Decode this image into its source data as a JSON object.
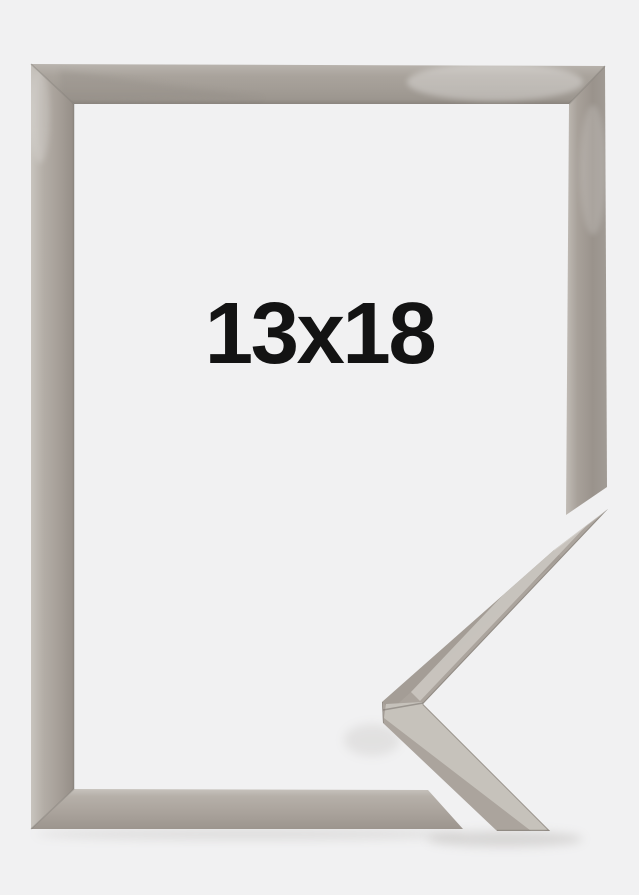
{
  "product_image": {
    "size_label": "13x18",
    "colors": {
      "background": "#f1f1f2",
      "frame_base": "#aba49d",
      "frame_highlight": "#c9c5bf",
      "frame_edge_dark": "#8b857e",
      "label_text": "#131313"
    }
  }
}
